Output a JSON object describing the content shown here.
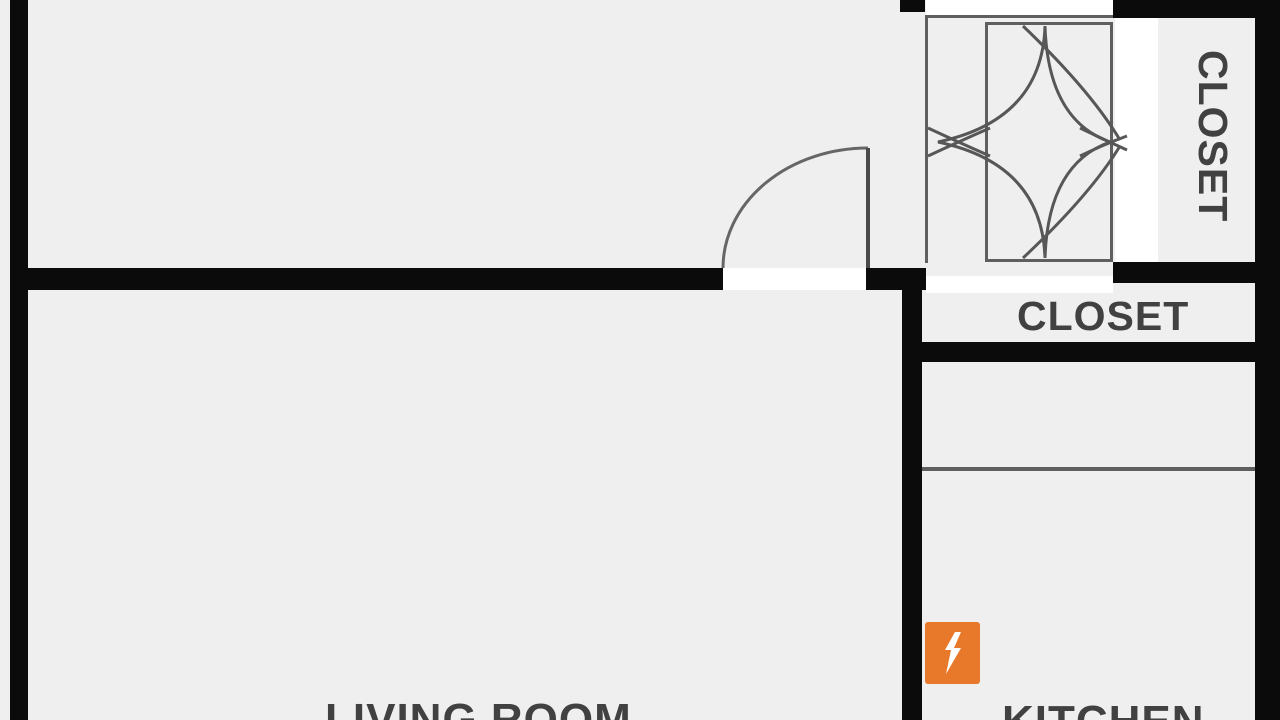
{
  "page": {
    "type": "apartment-floor-plan"
  },
  "labels": {
    "closet_top_right": "CLOSET",
    "closet_hall": "CLOSET",
    "living_room": "LIVING ROOM",
    "kitchen": "KITCHEN"
  },
  "icons": {
    "power_marker": "lightning-bolt-icon"
  },
  "colors": {
    "wall": "#0b0b0b",
    "background": "#efefef",
    "line": "#5f5f5f",
    "text": "#414141",
    "accent_orange": "#e8792a",
    "opening": "#ffffff"
  }
}
